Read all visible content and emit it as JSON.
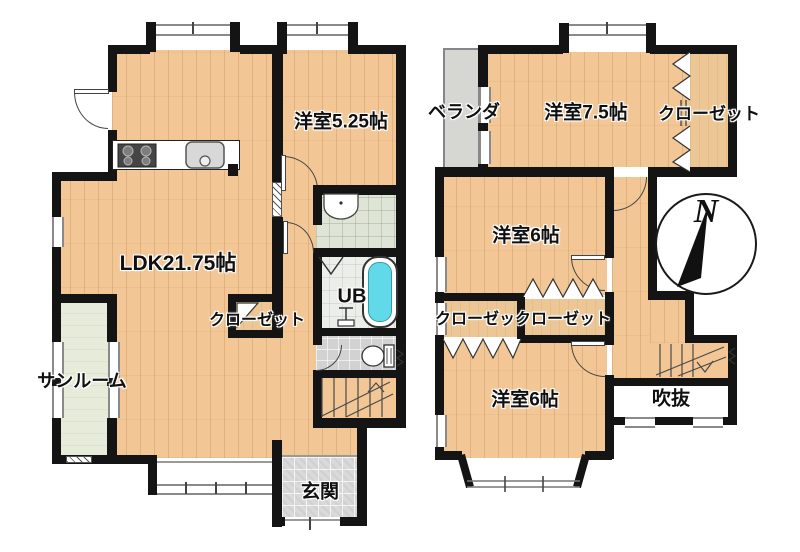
{
  "title": "2階建て住宅 間取り図",
  "colors": {
    "wall": "#141414",
    "wood": "#f2c695",
    "closet": "#ecc795",
    "sunroom": "#e6ecd9",
    "washroom": "#dfe5d6",
    "ub_tile": "#ebeee9",
    "toilet_tile": "#d2d2d2",
    "genkan_tile": "#d9d9d9",
    "tub": "#62d9e9",
    "veranda": "#d6d6d2"
  },
  "floor1": {
    "ldk": "LDK21.75帖",
    "bedroom525": "洋室5.25帖",
    "closet": "クローゼット",
    "sunroom": "サンルーム",
    "unit_bath": "UB",
    "entrance": "玄関"
  },
  "floor2": {
    "veranda": "ベランダ",
    "bedroom75": "洋室7.5帖",
    "closet_top": "クローゼット",
    "bedroom6_north": "洋室6帖",
    "closets_mid": "クローゼックローゼット",
    "bedroom6_south": "洋室6帖",
    "void": "吹抜"
  },
  "compass": {
    "north": "N"
  }
}
